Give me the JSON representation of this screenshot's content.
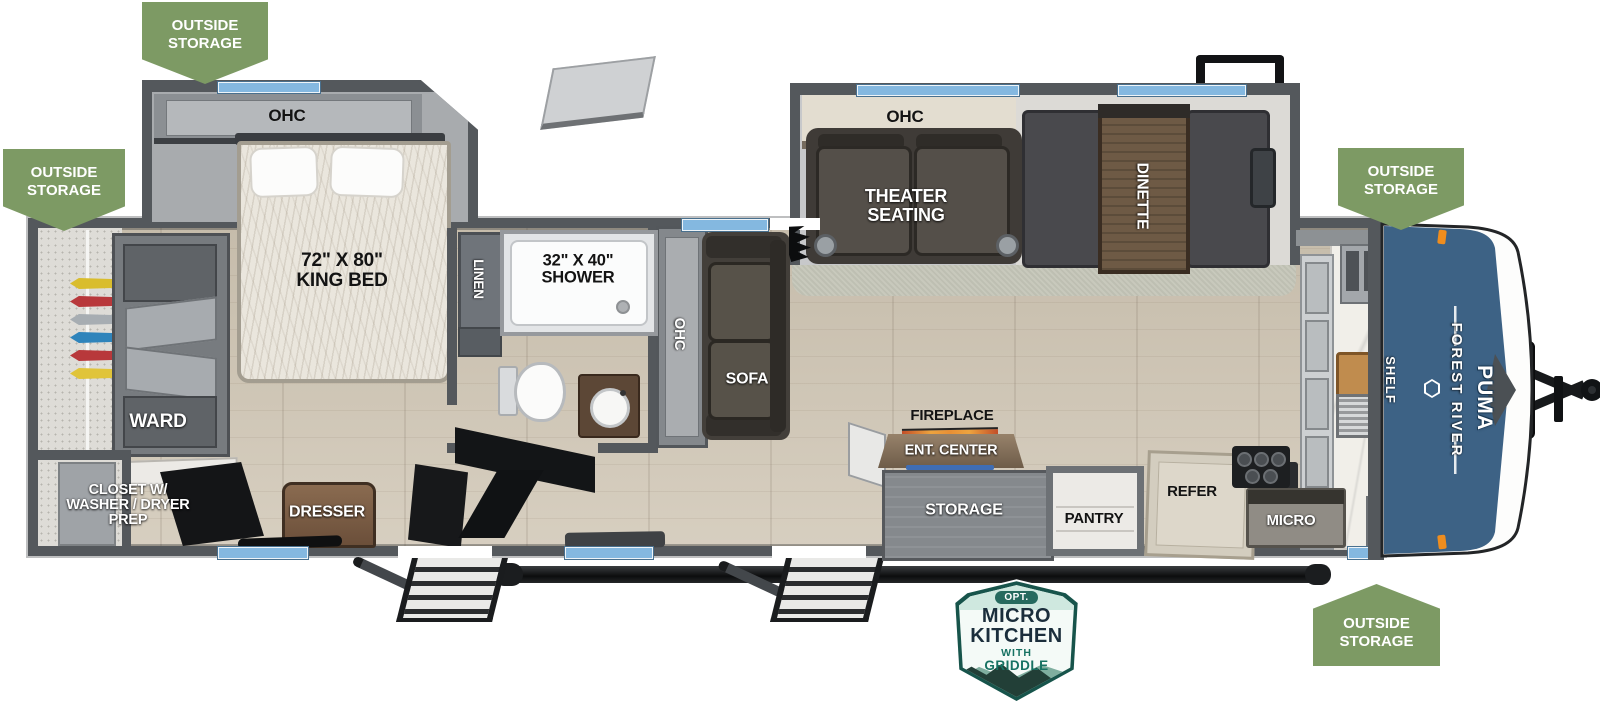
{
  "title": "Forest River Puma travel trailer floorplan",
  "badges": {
    "outside_storage": {
      "line1": "OUTSIDE",
      "line2": "STORAGE"
    },
    "micro_kitchen": {
      "opt": "OPT.",
      "line1": "MICRO",
      "line2": "KITCHEN",
      "line3": "WITH",
      "line4": "GRIDDLE"
    }
  },
  "branding": {
    "make": "FOREST RIVER",
    "model": "PUMA"
  },
  "rooms": {
    "bedroom_ohc": "OHC",
    "king_bed_size": "72\" X 80\"",
    "king_bed": "KING BED",
    "ward": "WARD",
    "closet_line1": "CLOSET W/",
    "closet_line2": "WASHER / DRYER",
    "closet_line3": "PREP",
    "dresser": "DRESSER",
    "linen": "LINEN",
    "shower_size": "32\" X 40\"",
    "shower": "SHOWER",
    "hall_ohc": "OHC",
    "sofa": "SOFA",
    "living_ohc": "OHC",
    "theater_line1": "THEATER",
    "theater_line2": "SEATING",
    "dinette": "DINETTE",
    "fireplace": "FIREPLACE",
    "ent_center": "ENT. CENTER",
    "storage": "STORAGE",
    "pantry": "PANTRY",
    "refer": "REFER",
    "micro": "MICRO",
    "shelf": "SHELF"
  },
  "colors": {
    "badge_green": "#7d9a64",
    "wall_gray": "#54585c",
    "cap_blue": "#3d6285",
    "window_blue": "#84b8e0",
    "badge_teal": "#17544b",
    "floor_wood": "#cec4b2",
    "marker_orange": "#ef8d1e"
  }
}
